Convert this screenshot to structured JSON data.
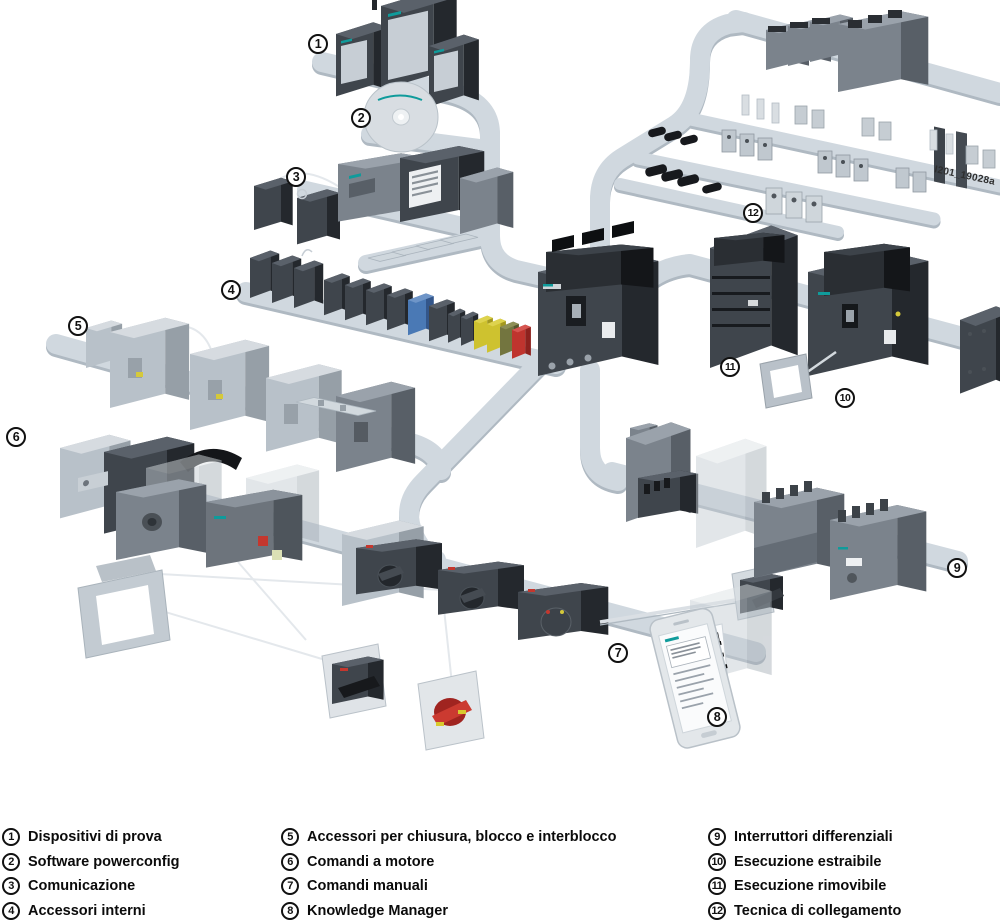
{
  "figure": {
    "watermark": "I201_19028a"
  },
  "callouts": [
    "1",
    "2",
    "3",
    "4",
    "5",
    "6",
    "7",
    "8",
    "9",
    "10",
    "11",
    "12"
  ],
  "legend": {
    "columns": [
      {
        "items": [
          {
            "num": "1",
            "label": "Dispositivi di prova"
          },
          {
            "num": "2",
            "label": "Software powerconfig"
          },
          {
            "num": "3",
            "label": "Comunicazione"
          },
          {
            "num": "4",
            "label": "Accessori interni"
          }
        ]
      },
      {
        "items": [
          {
            "num": "5",
            "label": "Accessori per chiusura, blocco e interblocco"
          },
          {
            "num": "6",
            "label": "Comandi a motore"
          },
          {
            "num": "7",
            "label": "Comandi manuali"
          },
          {
            "num": "8",
            "label": "Knowledge Manager"
          }
        ]
      },
      {
        "items": [
          {
            "num": "9",
            "label": "Interruttori differenziali"
          },
          {
            "num": "10",
            "label": "Esecuzione estraibile"
          },
          {
            "num": "11",
            "label": "Esecuzione rimovibile"
          },
          {
            "num": "12",
            "label": "Tecnica di collegamento"
          }
        ]
      }
    ]
  },
  "colors": {
    "rail": "#d0d8df",
    "rail_shadow": "#afb9c2",
    "device_dark": "#3f454c",
    "device_mid": "#7b838c",
    "device_light": "#b8c1c9",
    "accent_teal": "#0f9b9b",
    "accent_red": "#bf342e",
    "accent_yellow": "#d5c93a",
    "accent_blue": "#4a79b5"
  }
}
